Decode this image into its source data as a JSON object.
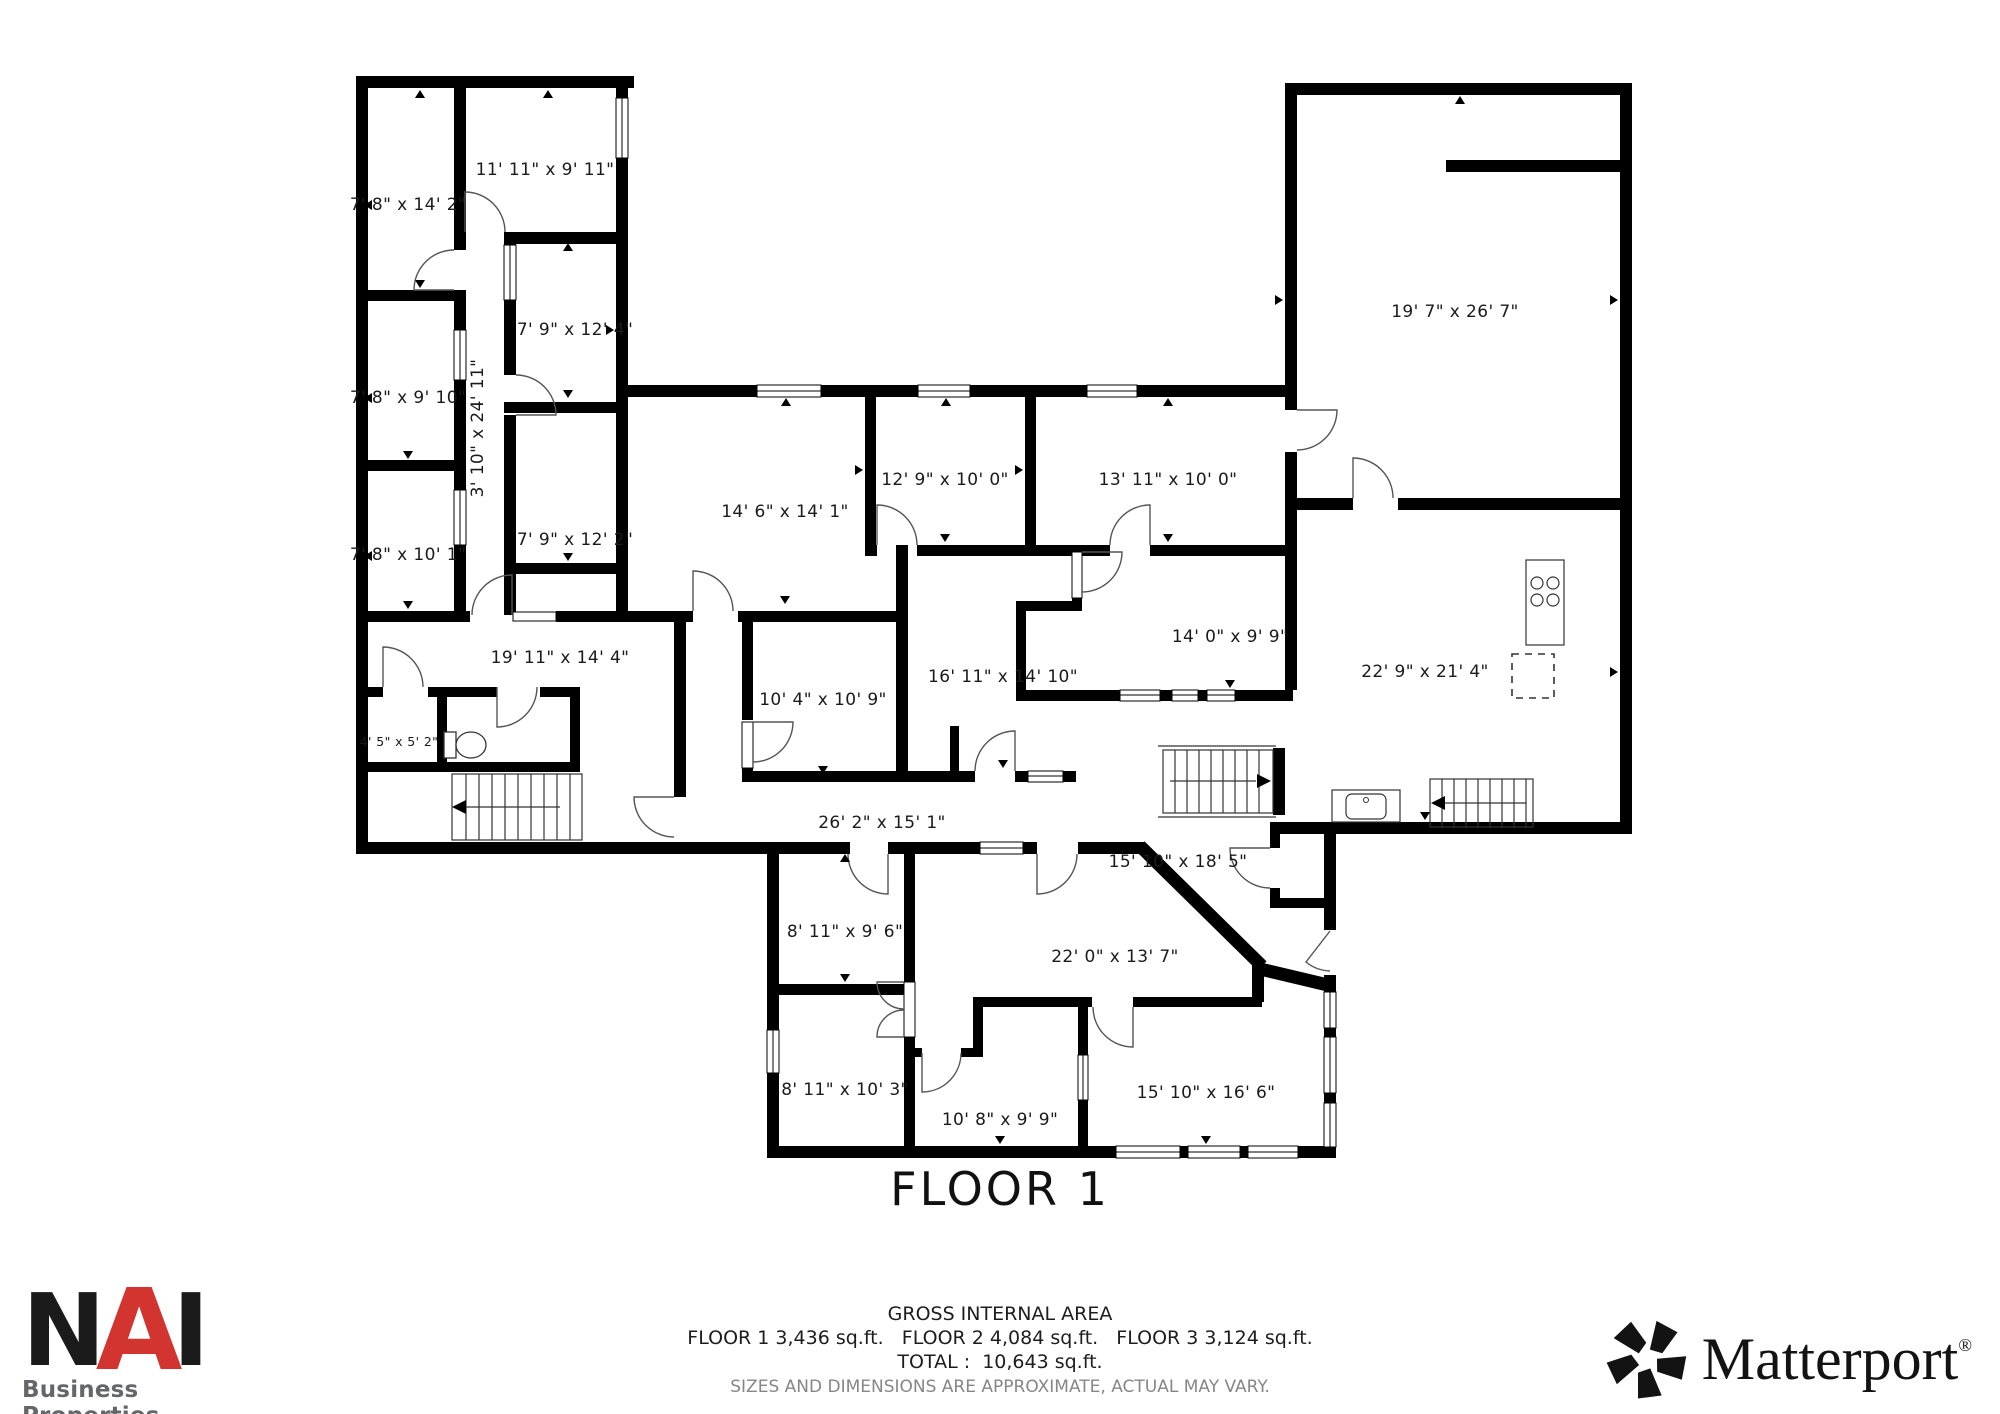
{
  "floor_plan": {
    "floor_label": "FLOOR 1",
    "rooms": [
      {
        "id": "1",
        "label": "7' 8\" x 14' 2\"",
        "x": 408,
        "y": 210,
        "rotate": 0,
        "small": false
      },
      {
        "id": "2",
        "label": "11' 11\" x 9' 11\"",
        "x": 545,
        "y": 175,
        "rotate": 0,
        "small": false
      },
      {
        "id": "3",
        "label": "7' 8\" x 9' 10\"",
        "x": 408,
        "y": 403,
        "rotate": 0,
        "small": false
      },
      {
        "id": "4",
        "label": "7' 8\" x 10' 1\"",
        "x": 408,
        "y": 560,
        "rotate": 0,
        "small": false
      },
      {
        "id": "5",
        "label": "3' 10\" x 24' 11\"",
        "x": 483,
        "y": 428,
        "rotate": -90,
        "small": false
      },
      {
        "id": "6",
        "label": "7' 9\" x 12' 4\"",
        "x": 575,
        "y": 335,
        "rotate": 0,
        "small": false
      },
      {
        "id": "7",
        "label": "7' 9\" x 12' 2\"",
        "x": 575,
        "y": 545,
        "rotate": 0,
        "small": false
      },
      {
        "id": "8",
        "label": "19' 11\" x 14' 4\"",
        "x": 560,
        "y": 663,
        "rotate": 0,
        "small": false
      },
      {
        "id": "9",
        "label": "4' 5\" x 5' 2\"",
        "x": 399,
        "y": 746,
        "rotate": 0,
        "small": true
      },
      {
        "id": "10",
        "label": "14' 6\" x 14' 1\"",
        "x": 785,
        "y": 517,
        "rotate": 0,
        "small": false
      },
      {
        "id": "11",
        "label": "12' 9\" x 10' 0\"",
        "x": 945,
        "y": 485,
        "rotate": 0,
        "small": false
      },
      {
        "id": "12",
        "label": "13' 11\" x 10' 0\"",
        "x": 1168,
        "y": 485,
        "rotate": 0,
        "small": false
      },
      {
        "id": "13",
        "label": "19' 7\" x 26' 7\"",
        "x": 1455,
        "y": 317,
        "rotate": 0,
        "small": false
      },
      {
        "id": "14",
        "label": "14' 0\" x 9' 9\"",
        "x": 1230,
        "y": 642,
        "rotate": 0,
        "small": false
      },
      {
        "id": "15",
        "label": "16' 11\" x 14' 10\"",
        "x": 1003,
        "y": 682,
        "rotate": 0,
        "small": false
      },
      {
        "id": "16",
        "label": "10' 4\" x 10' 9\"",
        "x": 823,
        "y": 705,
        "rotate": 0,
        "small": false
      },
      {
        "id": "17",
        "label": "22' 9\" x 21' 4\"",
        "x": 1425,
        "y": 677,
        "rotate": 0,
        "small": false
      },
      {
        "id": "18",
        "label": "26' 2\" x 15' 1\"",
        "x": 882,
        "y": 828,
        "rotate": 0,
        "small": false
      },
      {
        "id": "19",
        "label": "15' 10\" x 18' 5\"",
        "x": 1178,
        "y": 867,
        "rotate": 0,
        "small": false
      },
      {
        "id": "20",
        "label": "22' 0\" x 13' 7\"",
        "x": 1115,
        "y": 962,
        "rotate": 0,
        "small": false
      },
      {
        "id": "21",
        "label": "8' 11\" x 9' 6\"",
        "x": 845,
        "y": 937,
        "rotate": 0,
        "small": false
      },
      {
        "id": "22",
        "label": "8' 11\" x 10' 3\"",
        "x": 845,
        "y": 1095,
        "rotate": 0,
        "small": false
      },
      {
        "id": "23",
        "label": "10' 8\" x 9' 9\"",
        "x": 1000,
        "y": 1125,
        "rotate": 0,
        "small": false
      },
      {
        "id": "24",
        "label": "15' 10\" x 16' 6\"",
        "x": 1206,
        "y": 1098,
        "rotate": 0,
        "small": false
      }
    ]
  },
  "footer": {
    "gross_area_title": "GROSS INTERNAL AREA",
    "floors_line": "FLOOR 1 3,436 sq.ft.   FLOOR 2 4,084 sq.ft.   FLOOR 3 3,124 sq.ft.",
    "total_line": "TOTAL :  10,643 sq.ft.",
    "disclaimer": "SIZES AND DIMENSIONS ARE APPROXIMATE, ACTUAL MAY VARY."
  },
  "branding": {
    "nai": {
      "n": "N",
      "a": "A",
      "i": "I",
      "subtitle": "Business Properties"
    },
    "matterport": {
      "name": "Matterport",
      "registered": "®"
    }
  }
}
